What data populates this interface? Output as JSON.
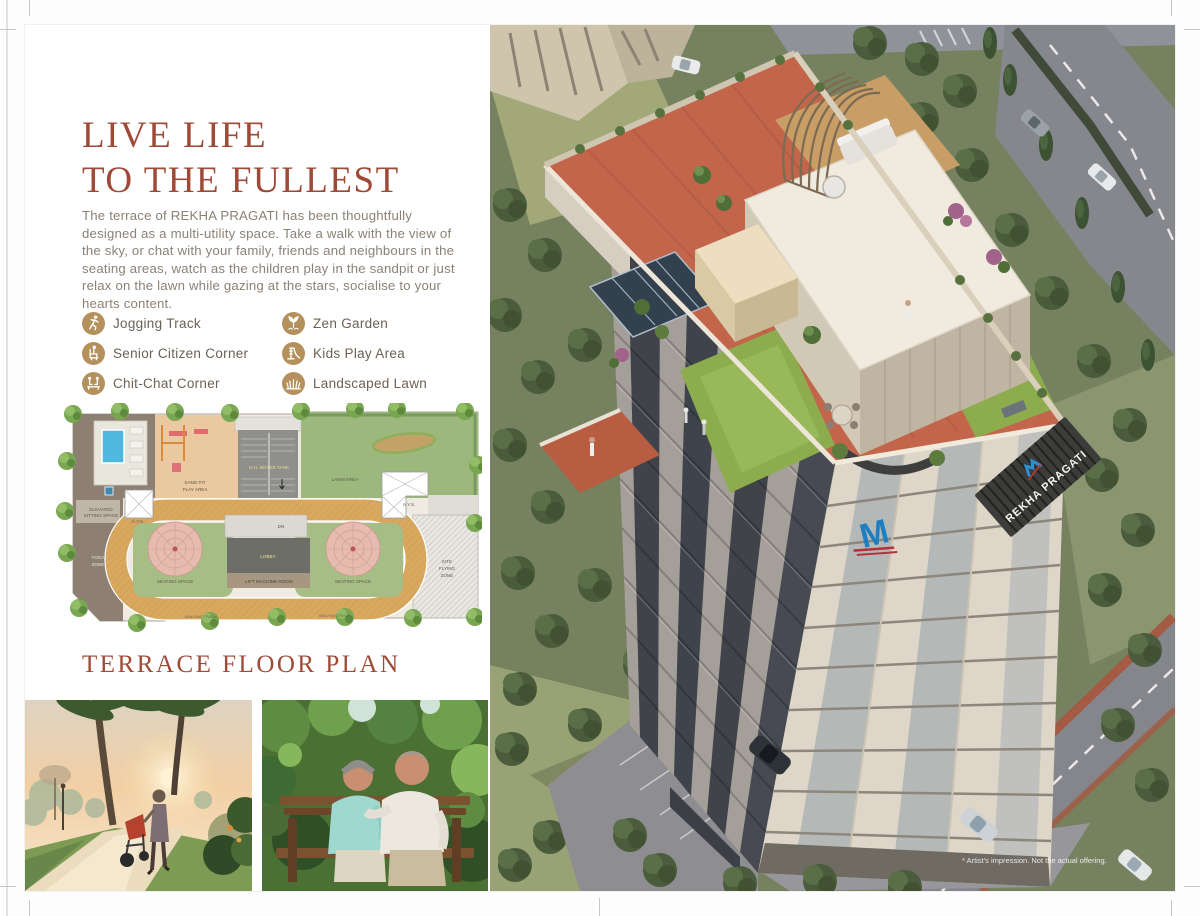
{
  "page": {
    "heading_line1": "LIVE LIFE",
    "heading_line2": "TO THE FULLEST",
    "intro": "The terrace of REKHA PRAGATI has been thoughtfully designed as a multi-utility space. Take a walk with the view of the sky, or chat with your family, friends and neighbours in the seating areas, watch as the children play in the sandpit or just relax on the lawn while gazing at the stars, socialise to your hearts content.",
    "plan_title": "TERRACE FLOOR PLAN"
  },
  "amenities": [
    {
      "label": "Jogging Track",
      "icon": "jogging-icon"
    },
    {
      "label": "Senior Citizen Corner",
      "icon": "senior-citizen-icon"
    },
    {
      "label": "Chit-Chat Corner",
      "icon": "chit-chat-icon"
    },
    {
      "label": "Zen Garden",
      "icon": "zen-garden-icon"
    },
    {
      "label": "Kids Play Area",
      "icon": "kids-play-icon"
    },
    {
      "label": "Landscaped Lawn",
      "icon": "landscaped-lawn-icon"
    }
  ],
  "floor_plan": {
    "labels": {
      "elevated_1": "ELEVATED",
      "elevated_2": "SITTING SPACE",
      "ays": "A.Y.S.",
      "sand_1": "SAND PIT",
      "sand_2": "PLAY AREA",
      "tank": "O.H. WATER TANK",
      "lawn": "LAWN AREA",
      "dn": "DN",
      "lobby": "LOBBY",
      "lift": "LIFT MACHINE ROOM",
      "seating": "SEATING SPACE",
      "yoga_1": "YOGA",
      "yoga_2": "ZONE",
      "kite_1": "KITE",
      "kite_2": "FLYING",
      "kite_3": "ZONE",
      "track": "WALKING TRACK"
    }
  },
  "render": {
    "building_name": "REKHA PRAGATI",
    "logo_letter": "M",
    "disclaimer": "* Artist's impression. Not the actual offering."
  },
  "colors": {
    "accent_red": "#9F4937",
    "icon_gold": "#B3905C",
    "body_text": "#8B8175"
  }
}
